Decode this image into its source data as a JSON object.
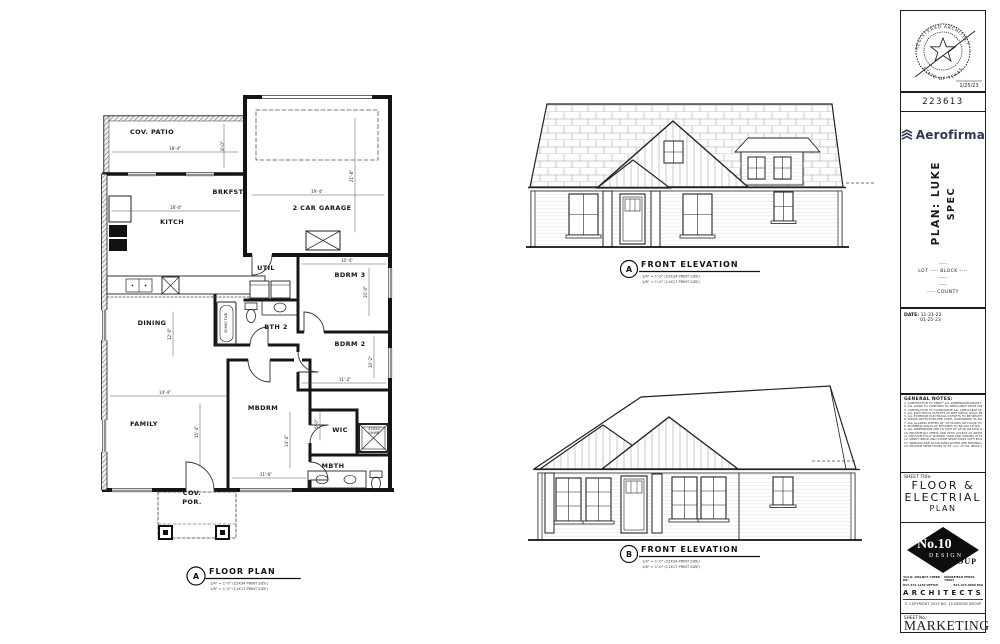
{
  "floor_plan": {
    "rooms": [
      {
        "label": "COV. PATIO",
        "x": 152,
        "y": 134
      },
      {
        "label": "BRKFST",
        "x": 228,
        "y": 194
      },
      {
        "label": "KITCH",
        "x": 172,
        "y": 224
      },
      {
        "label": "2 CAR GARAGE",
        "x": 322,
        "y": 210
      },
      {
        "label": "UTIL",
        "x": 266,
        "y": 270
      },
      {
        "label": "BDRM 3",
        "x": 350,
        "y": 277
      },
      {
        "label": "BTH 2",
        "x": 276,
        "y": 329
      },
      {
        "label": "BDRM 2",
        "x": 350,
        "y": 346
      },
      {
        "label": "DINING",
        "x": 152,
        "y": 325
      },
      {
        "label": "FAMILY",
        "x": 144,
        "y": 426
      },
      {
        "label": "MBDRM",
        "x": 263,
        "y": 410
      },
      {
        "label": "WIC",
        "x": 340,
        "y": 432
      },
      {
        "label": "MBTH",
        "x": 333,
        "y": 468
      },
      {
        "label": "COV.",
        "x": 192,
        "y": 495
      },
      {
        "label": "POR.",
        "x": 192,
        "y": 504
      }
    ],
    "fixtures": [
      {
        "t": "42X54",
        "x": 374,
        "y": 430
      },
      {
        "t": "SHWR",
        "x": 374,
        "y": 434
      },
      {
        "t": "30X60 TUB",
        "x": 227,
        "y": 323,
        "v": true
      }
    ],
    "dims": [
      {
        "t": "18'-4\"",
        "x": 175,
        "y": 150
      },
      {
        "t": "8'-0\"",
        "x": 224,
        "y": 146,
        "v": true
      },
      {
        "t": "18'-0\"",
        "x": 176,
        "y": 209
      },
      {
        "t": "19'-4\"",
        "x": 317,
        "y": 193
      },
      {
        "t": "21'-8\"",
        "x": 353,
        "y": 176,
        "v": true
      },
      {
        "t": "10'-4\"",
        "x": 347,
        "y": 262
      },
      {
        "t": "10'-0\"",
        "x": 367,
        "y": 292,
        "v": true
      },
      {
        "t": "11'-2\"",
        "x": 345,
        "y": 381
      },
      {
        "t": "10'-2\"",
        "x": 372,
        "y": 362,
        "v": true
      },
      {
        "t": "12'-0\"",
        "x": 171,
        "y": 334,
        "v": true
      },
      {
        "t": "14'-4\"",
        "x": 165,
        "y": 394
      },
      {
        "t": "15'-4\"",
        "x": 198,
        "y": 432,
        "v": true
      },
      {
        "t": "14'-4\"",
        "x": 288,
        "y": 441,
        "v": true
      },
      {
        "t": "11'-6\"",
        "x": 266,
        "y": 476
      },
      {
        "t": "5'-0\"",
        "x": 318,
        "y": 424,
        "v": true
      }
    ],
    "callout": {
      "letter": "A",
      "title": "FLOOR PLAN",
      "scale1": "1/4\" = 1'-0\"   (22X34 PRINT SIZE)",
      "scale2": "1/8\" = 1'-0\"   (11X17 PRINT SIZE)"
    }
  },
  "elevations": {
    "a": {
      "letter": "A",
      "title": "FRONT ELEVATION",
      "scale1": "1/4\" = 1'-0\"   (22X34 PRINT SIZE)",
      "scale2": "1/8\" = 1'-0\"   (11X17 PRINT SIZE)"
    },
    "b": {
      "letter": "B",
      "title": "FRONT ELEVATION",
      "scale1": "1/4\" = 1'-0\"   (22X34 PRINT SIZE)",
      "scale2": "1/8\" = 1'-0\"   (11X17 PRINT SIZE)"
    }
  },
  "title_block": {
    "stamp": {
      "arc_top": "REGISTERED ARCHITECT",
      "arc_bottom": "STATE OF TEXAS",
      "date": "1/25/23"
    },
    "project_number": "223613",
    "brand": {
      "name": "Aerofirma",
      "color": "#2b3a52"
    },
    "plan_line1": "PLAN: LUKE",
    "plan_line2": "SPEC",
    "site": [
      "----",
      "LOT ---- BLOCK ----",
      "----",
      "----",
      "---- COUNTY"
    ],
    "date_label": "DATE:",
    "date1": "11-21-22",
    "date2": "01-25-23",
    "notes_title": "GENERAL NOTES:",
    "notes": [
      "1. CONTRACTOR TO VERIFY ALL DIMENSIONS PRIOR TO CONSTRUCTION.",
      "2. ALL WORK TO CONFORM TO APPLICABLE STATE AND LOCAL BUILDING CODES.",
      "3. CONTRACTOR TO COORDINATE ALL APPLICABLE STATE AND LOCAL CODES AND ORDINANCES.",
      "4. ALL ELECTRICAL OUTLETS AT WET AREAS SHALL BE GFI PROTECTED.",
      "5. ALL EXTERIOR ELECTRICAL OUTLETS TO BE WEATHERPROOF GFI.",
      "6. SMOKE DETECTORS PER CODE, HARDWIRED W/ BATTERY BACKUP.",
      "7. ALL GLAZING WITHIN 18\" OF DOORS OR FLOOR TO BE TEMPERED GLASS.",
      "8. PLUMBING WALLS AT FIXTURES TO BE 2X6 STUDS.",
      "9. ALL DIMENSIONS ARE TO FACE OF STUD OR FACE OF CONCRETE U.N.O.",
      "10. PROVIDE R/A VENTS AND ATTIC ACCESS AS SHOWN ON PLAN.",
      "11. PROVIDE FULLY SODDED YARD AND SHRUBS AT FRONT ELEVATION.",
      "12. VERIFY BRICK AND STONE SELECTIONS WITH BUILDER.",
      "13. WINDOW AND DOOR SIZES NOTED ARE NOMINAL, VERIFY W/ MFR.",
      "14. PROVIDE WEEP HOLES AT 33\" O.C. AT ALL BRICK VENEER."
    ],
    "sheet_title_label": "SHEET Title:",
    "sheet_title": [
      "FLOOR &",
      "ELECTRIAL",
      "PLAN"
    ],
    "firm": {
      "no10": "No.10",
      "design": "DESIGN",
      "group": "GROUP",
      "addr_left1": "314 N. WALNUT CREEK DR.",
      "addr_left2": "817-473-1130 OFFICE",
      "addr_right1": "MANSFIELD TEXAS 76063",
      "addr_right2": "817-473-0666 FAX",
      "architects": "ARCHITECTS",
      "copyright": "© COPYRIGHT 2023 NO. 10 DESIGN GROUP"
    },
    "sheet_no_label": "SHEET No.:",
    "sheet_no": "MARKETING"
  }
}
